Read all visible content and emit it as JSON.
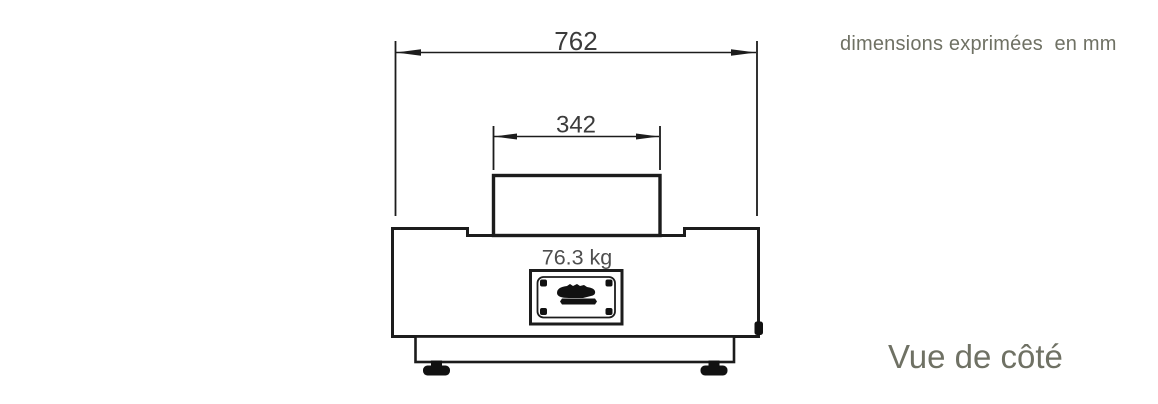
{
  "drawing": {
    "title": "appliance side elevation technical drawing",
    "dimensions": {
      "overall_width_mm": "762",
      "top_width_mm": "342",
      "weight": "76.3 kg"
    }
  },
  "annotations": {
    "units_note": "dimensions exprimées  en mm",
    "view_label": "Vue de côté"
  },
  "colors": {
    "background": "#ffffff",
    "line": "#1c1c1c",
    "dimension_text": "#3b3b3b",
    "weight_text": "#4e4e4e",
    "annotation_text": "#6f7164"
  }
}
